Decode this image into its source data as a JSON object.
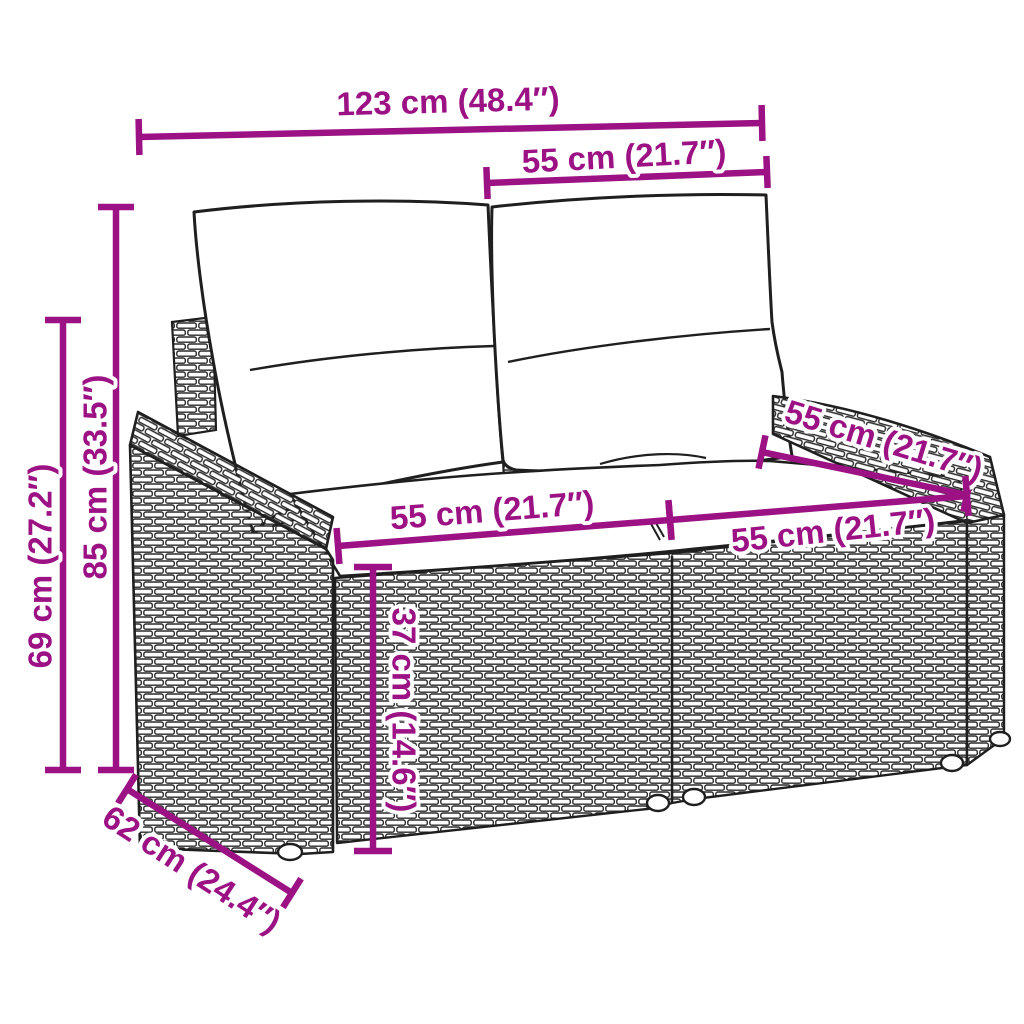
{
  "page": {
    "background_color": "#ffffff"
  },
  "illustration": {
    "subject": "2-seater poly rattan garden sofa with back pillows and seat cushions, black line drawing",
    "ink_color": "#1f1f1f"
  },
  "dimensions": {
    "color": "#9C1184",
    "items": [
      {
        "name": "overall-width",
        "label": "123 cm (48.4″)",
        "x1": 139,
        "y1": 137,
        "x2": 762,
        "y2": 123,
        "tx": 448,
        "ty": 101,
        "rot": -1.5,
        "tick": 18
      },
      {
        "name": "backrest-cushion-width",
        "label": "55 cm (21.7″)",
        "x1": 487,
        "y1": 183,
        "x2": 767,
        "y2": 172,
        "tx": 624,
        "ty": 156,
        "rot": -3,
        "tick": 16
      },
      {
        "name": "overall-height",
        "label": "85 cm (33.5″)",
        "x1": 116,
        "y1": 207,
        "x2": 116,
        "y2": 770,
        "tx": 95,
        "ty": 477,
        "rot": -90,
        "tick": 18
      },
      {
        "name": "armrest-height",
        "label": "69 cm (27.2″)",
        "x1": 63,
        "y1": 320,
        "x2": 63,
        "y2": 770,
        "tx": 40,
        "ty": 566,
        "rot": -90,
        "tick": 18
      },
      {
        "name": "seat-depth",
        "label": "55 cm (21.7″)",
        "x1": 762,
        "y1": 452,
        "x2": 967,
        "y2": 495,
        "tx": 884,
        "ty": 440,
        "rot": 17,
        "tick": 17
      },
      {
        "name": "seat-width-left-module",
        "label": "55 cm (21.7″)",
        "x1": 338,
        "y1": 546,
        "x2": 670,
        "y2": 520,
        "tx": 492,
        "ty": 510,
        "rot": -4.5,
        "tick": 18
      },
      {
        "name": "seat-width-right-module",
        "label": "55 cm (21.7″)",
        "x1": 670,
        "y1": 520,
        "x2": 967,
        "y2": 496,
        "tx": 833,
        "ty": 530,
        "rot": -6,
        "tick": 20
      },
      {
        "name": "seat-height",
        "label": "37 cm (14.6″)",
        "x1": 373,
        "y1": 567,
        "x2": 373,
        "y2": 851,
        "tx": 404,
        "ty": 710,
        "rot": 90,
        "tick": 19
      },
      {
        "name": "overall-depth",
        "label": "62 cm (24.4″)",
        "x1": 127,
        "y1": 789,
        "x2": 292,
        "y2": 893,
        "tx": 192,
        "ty": 869,
        "rot": 33,
        "tick": 17
      }
    ]
  }
}
